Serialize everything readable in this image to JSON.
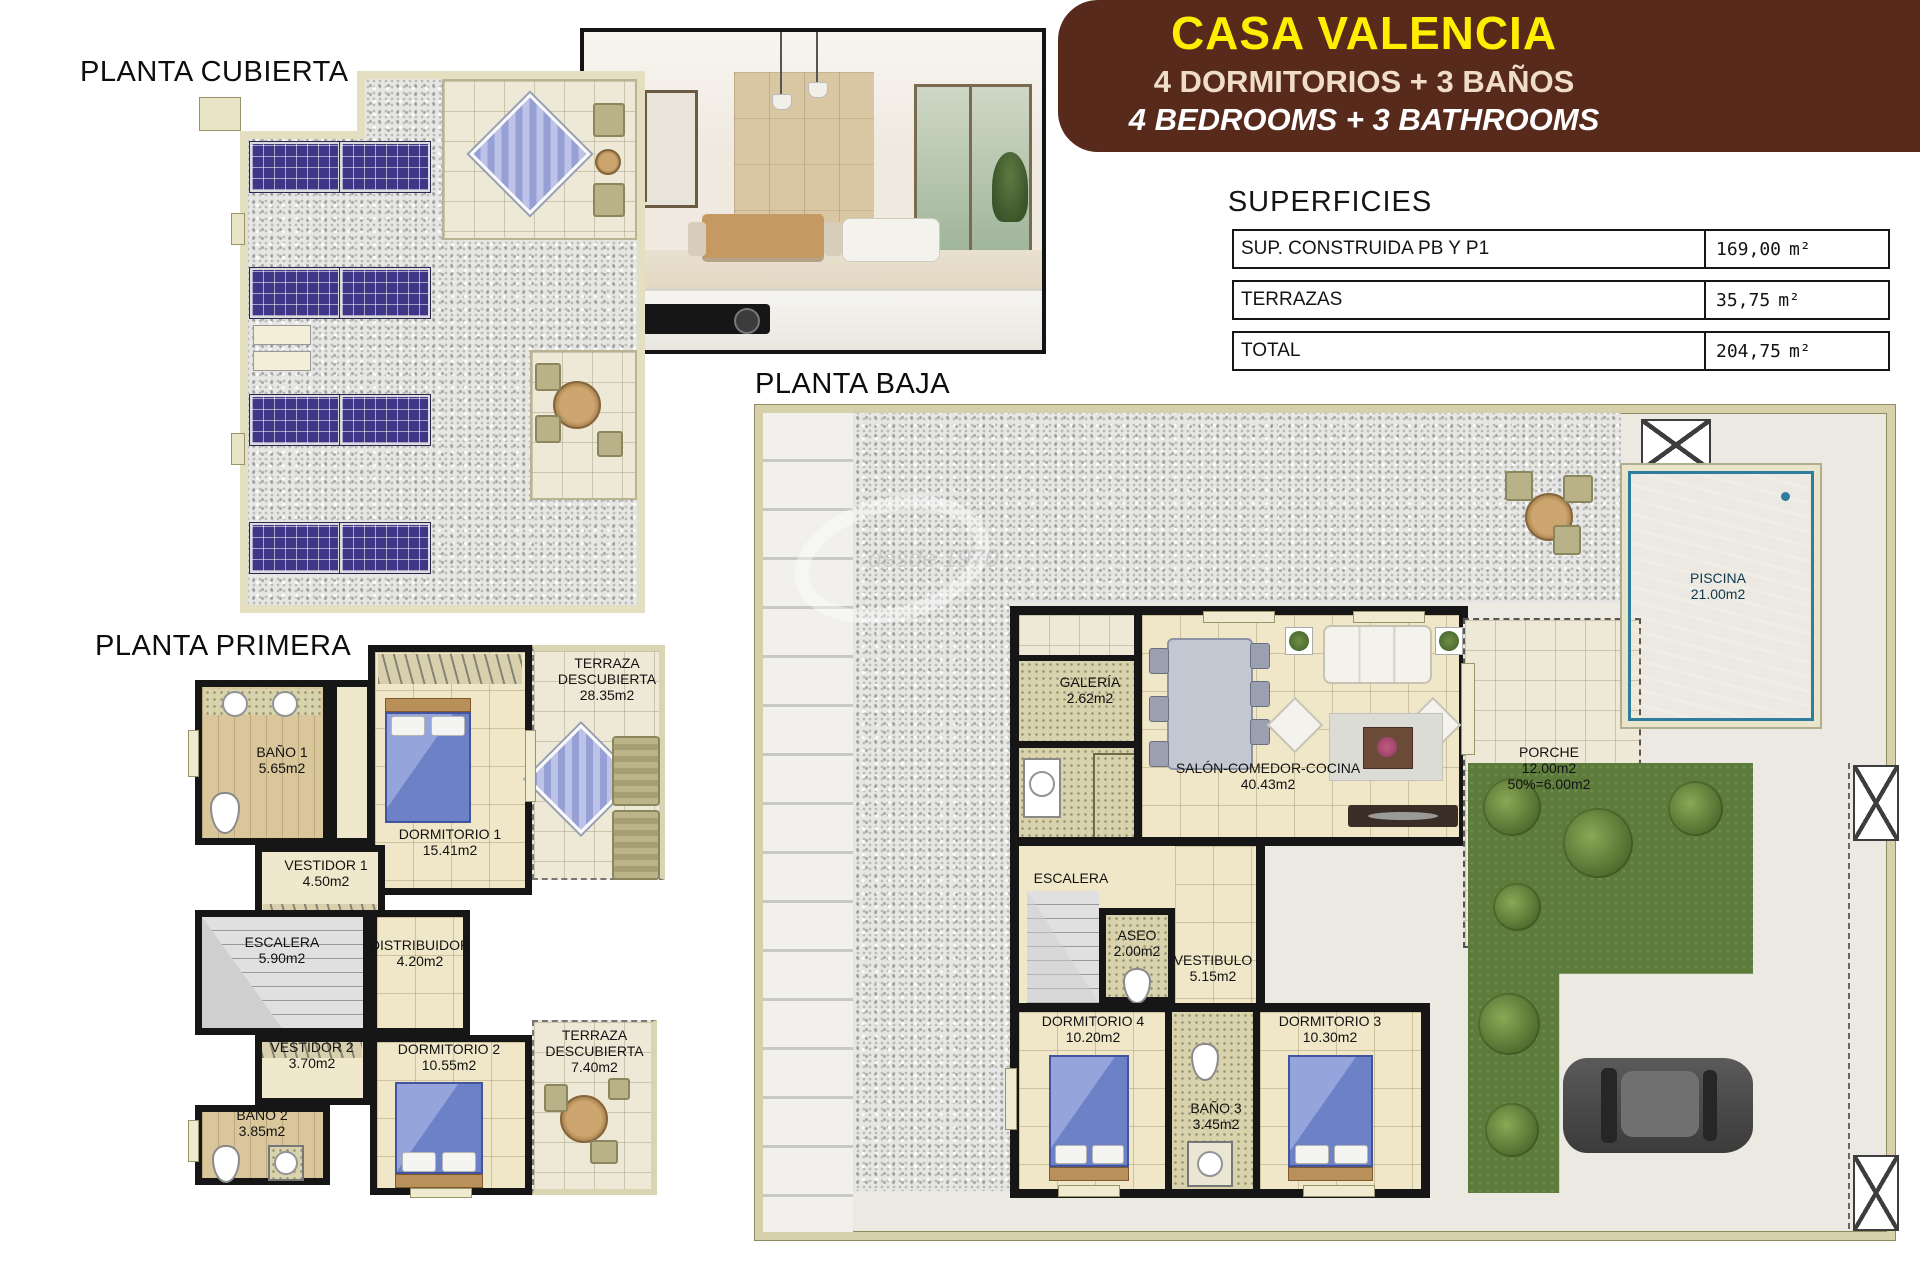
{
  "header": {
    "title": "CASA VALENCIA",
    "subtitle_es": "4 DORMITORIOS + 3 BAÑOS",
    "subtitle_en": "4 BEDROOMS + 3 BATHROOMS"
  },
  "superficies": {
    "title": "SUPERFICIES",
    "rows": [
      {
        "label": "SUP. CONSTRUIDA PB Y P1",
        "value": "169,00",
        "unit": "m²"
      },
      {
        "label": "TERRAZAS",
        "value": "35,75",
        "unit": "m²"
      },
      {
        "label": "TOTAL",
        "value": "204,75",
        "unit": "m²"
      }
    ]
  },
  "cubierta": {
    "title": "PLANTA CUBIERTA"
  },
  "primera": {
    "title": "PLANTA PRIMERA",
    "bano1": {
      "name": "BAÑO 1",
      "area": "5.65m2"
    },
    "vestidor1": {
      "name": "VESTIDOR 1",
      "area": "4.50m2"
    },
    "dormitorio1": {
      "name": "DORMITORIO 1",
      "area": "15.41m2"
    },
    "terraza1": {
      "name": "TERRAZA DESCUBIERTA",
      "area": "28.35m2"
    },
    "escalera": {
      "name": "ESCALERA",
      "area": "5.90m2"
    },
    "distribuidor": {
      "name": "DISTRIBUIDOR",
      "area": "4.20m2"
    },
    "vestidor2": {
      "name": "VESTIDOR 2",
      "area": "3.70m2"
    },
    "dormitorio2": {
      "name": "DORMITORIO 2",
      "area": "10.55m2"
    },
    "bano2": {
      "name": "BAÑO 2",
      "area": "3.85m2"
    },
    "terraza2": {
      "name": "TERRAZA DESCUBIERTA",
      "area": "7.40m2"
    }
  },
  "baja": {
    "title": "PLANTA BAJA",
    "galeria": {
      "name": "GALERÍA",
      "area": "2.62m2"
    },
    "salon": {
      "name": "SALÓN-COMEDOR-COCINA",
      "area": "40.43m2"
    },
    "porche": {
      "name": "PORCHE",
      "area": "12.00m2",
      "extra": "50%=6.00m2"
    },
    "piscina": {
      "name": "PISCINA",
      "area": "21.00m2"
    },
    "escalera": {
      "name": "ESCALERA"
    },
    "aseo": {
      "name": "ASEO",
      "area": "2.00m2"
    },
    "vestibulo": {
      "name": "VESTIBULO",
      "area": "5.15m2"
    },
    "dormitorio4": {
      "name": "DORMITORIO 4",
      "area": "10.20m2"
    },
    "bano3": {
      "name": "BAÑO 3",
      "area": "3.45m2"
    },
    "dormitorio3": {
      "name": "DORMITORIO 3",
      "area": "10.30m2"
    }
  },
  "watermark": {
    "text": "desde 1970"
  },
  "colors": {
    "banner_bg": "#572a1c",
    "banner_title": "#ffee00",
    "banner_sub": "#f0ddc8",
    "pool": "#5fb6d6",
    "garden": "#5d7c3c",
    "solar_panel": "#3f3688",
    "wall": "#161616",
    "cream": "#e5e1c2"
  }
}
